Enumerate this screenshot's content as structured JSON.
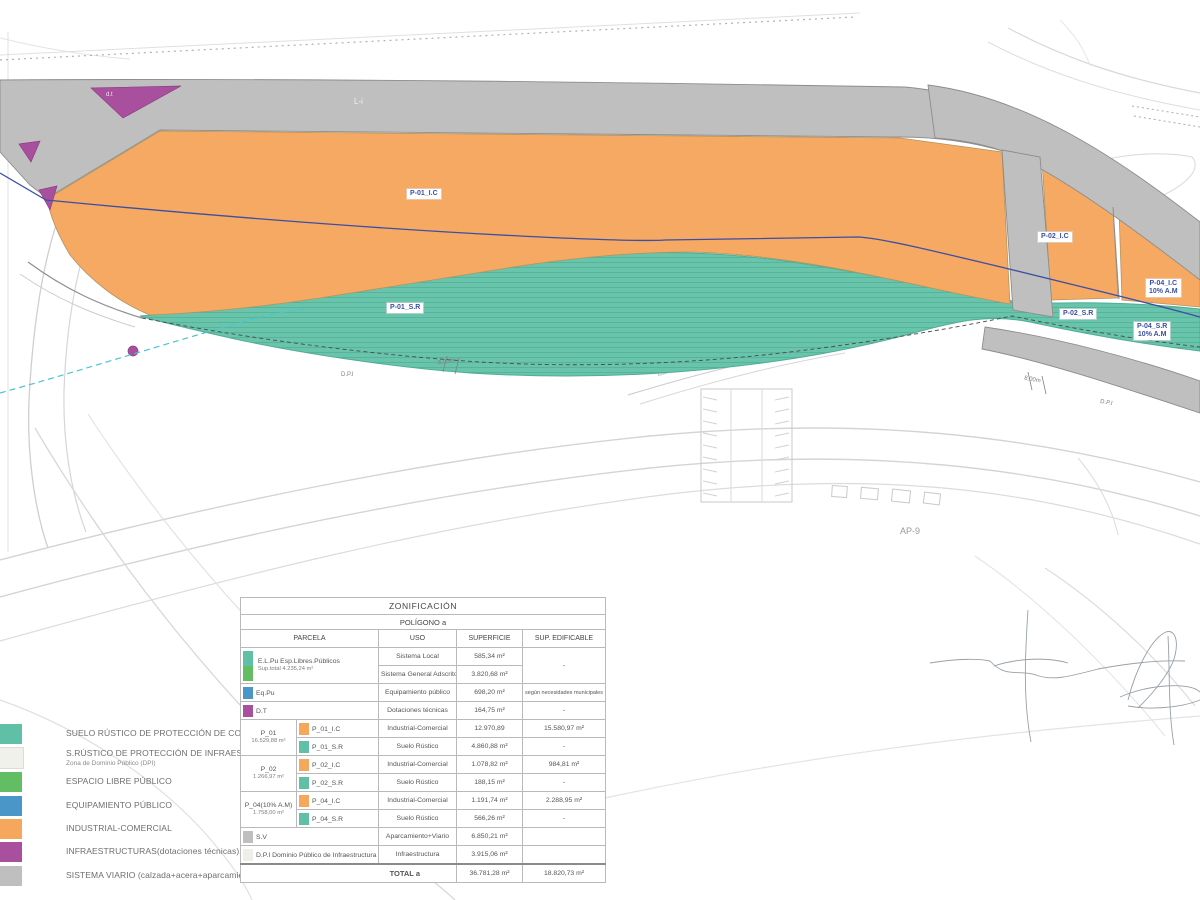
{
  "colors": {
    "teal": "#5FBFA7",
    "teal_fill": "#69C4AC",
    "green": "#63BE63",
    "blue": "#4A96C8",
    "orange": "#F5A85C",
    "purple": "#A8509E",
    "gray": "#BFBFBF",
    "light": "#EFEFEA",
    "navy_line": "#3C4FA3",
    "cyan_line": "#4AC3D6"
  },
  "map_labels": {
    "p01_ic": "P-01_I.C",
    "p01_sr": "P-01_S.R",
    "p02_ic": "P-02_I.C",
    "p02_sr": "P-02_S.R",
    "p04_ic": "P-04_I.C",
    "p04_ic_sub": "10% A.M",
    "p04_sr": "P-04_S.R",
    "p04_sr_sub": "10% A.M",
    "dt_small": "d.t",
    "road_top": "L-i",
    "highway": "AP-9",
    "dpi_left": "D.P.I",
    "dpi_right": "D.P.I",
    "dim_left": "8,00m",
    "dim_right": "8,00m"
  },
  "legend": {
    "items": [
      {
        "label": "SUELO RÚSTICO DE PROTECCIÓN DE COSTAS",
        "color": "#5FBFA7",
        "sub": ""
      },
      {
        "label": "S.RÚSTICO DE PROTECCIÓN DE INFRAESTRUCTURAS",
        "sub": "Zona de Dominio Público (DPI)",
        "color": "#F1F1EC"
      },
      {
        "label": "ESPACIO LIBRE PÚBLICO",
        "color": "#63BE63",
        "sub": ""
      },
      {
        "label": "EQUIPAMIENTO PÚBLICO",
        "color": "#4A96C8",
        "sub": ""
      },
      {
        "label": "INDUSTRIAL-COMERCIAL",
        "color": "#F5A85C",
        "sub": ""
      },
      {
        "label": "INFRAESTRUCTURAS(dotaciones técnicas)",
        "color": "#A8509E",
        "sub": ""
      },
      {
        "label": "SISTEMA VIARIO (calzada+acera+aparcamiento)",
        "color": "#BFBFBF",
        "sub": ""
      }
    ]
  },
  "table": {
    "title": "ZONIFICACIÓN",
    "subtitle": "POLÍGONO a",
    "col_parcela": "PARCELA",
    "col_uso": "USO",
    "col_superficie": "SUPERFICIE",
    "col_edificable": "SUP. EDIFICABLE",
    "elpu": {
      "name": "E.L.Pu Esp.Libres.Públicos",
      "sub": "Sup.total 4.235,24 m²",
      "uso1": "Sistema Local",
      "sup1": "585,34 m²",
      "uso2": "Sistema General Adscrito",
      "sup2": "3.820,68 m²",
      "edif": "-"
    },
    "eqpu": {
      "name": "Eq.Pu",
      "uso": "Equipamiento público",
      "sup": "698,20 m²",
      "edif": "según necesidades municipales"
    },
    "dt": {
      "name": "D.T",
      "uso": "Dotaciones técnicas",
      "sup": "164,75 m²",
      "edif": "-"
    },
    "p01": {
      "name": "P_01",
      "sub": "16.529,88 m²",
      "ic_code": "P_01_I.C",
      "ic_uso": "Industrial-Comercial",
      "ic_sup": "12.970,89",
      "ic_edif": "15.580,97 m²",
      "sr_code": "P_01_S.R",
      "sr_uso": "Suelo Rústico",
      "sr_sup": "4.860,88 m²",
      "sr_edif": "-"
    },
    "p02": {
      "name": "P_02",
      "sub": "1.266,97 m²",
      "ic_code": "P_02_I.C",
      "ic_uso": "Industrial-Comercial",
      "ic_sup": "1.078,82 m²",
      "ic_edif": "984,81 m²",
      "sr_code": "P_02_S.R",
      "sr_uso": "Suelo Rústico",
      "sr_sup": "188,15 m²",
      "sr_edif": "-"
    },
    "p04": {
      "name": "P_04(10% A.M)",
      "sub": "1.758,00 m²",
      "ic_code": "P_04_I.C",
      "ic_uso": "Industrial-Comercial",
      "ic_sup": "1.191,74 m²",
      "ic_edif": "2.288,95 m²",
      "sr_code": "P_04_S.R",
      "sr_uso": "Suelo Rústico",
      "sr_sup": "566,26 m²",
      "sr_edif": "-"
    },
    "sv": {
      "name": "S.V",
      "uso": "Aparcamiento+Viario",
      "sup": "6.850,21 m²"
    },
    "dpi": {
      "name": "D.P.I Dominio Público de Infraestructura",
      "uso": "Infraestructura",
      "sup": "3.915,06 m²"
    },
    "total": {
      "label": "TOTAL a",
      "sup": "36.781,28 m²",
      "edif": "18.820,73 m²"
    }
  }
}
